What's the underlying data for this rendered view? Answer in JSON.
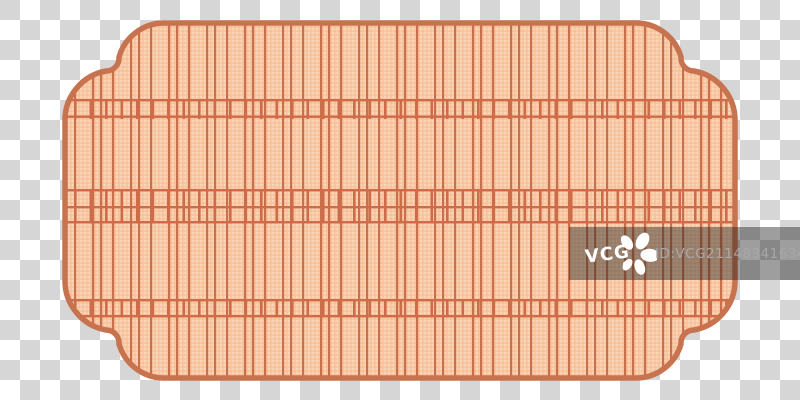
{
  "image": {
    "description": "Stock-asset preview of an ornamental bamboo-mat style plaque frame on a transparency checkerboard",
    "background": {
      "checker_light": "#ffffff",
      "checker_dark": "#d6d6d6",
      "checker_size_px": 20
    }
  },
  "frame": {
    "label": "ornamental-plaque-frame",
    "border_color": "#c8734f",
    "fill_color": "#f9c8a2",
    "slat_line_color": "#c96f4b",
    "band_line_color": "#cf6b49",
    "texture_light": "rgba(255,255,255,0.22)",
    "texture_dark": "rgba(203,128,82,0.10)"
  },
  "watermark": {
    "brand": "VCG",
    "id_text": "ID:VCG211483416341",
    "bg_color": "rgba(35,35,35,0.44)",
    "brand_color": "#ffffff",
    "id_color": "#a8a8a8",
    "flower_icon_color": "#ffffff"
  }
}
